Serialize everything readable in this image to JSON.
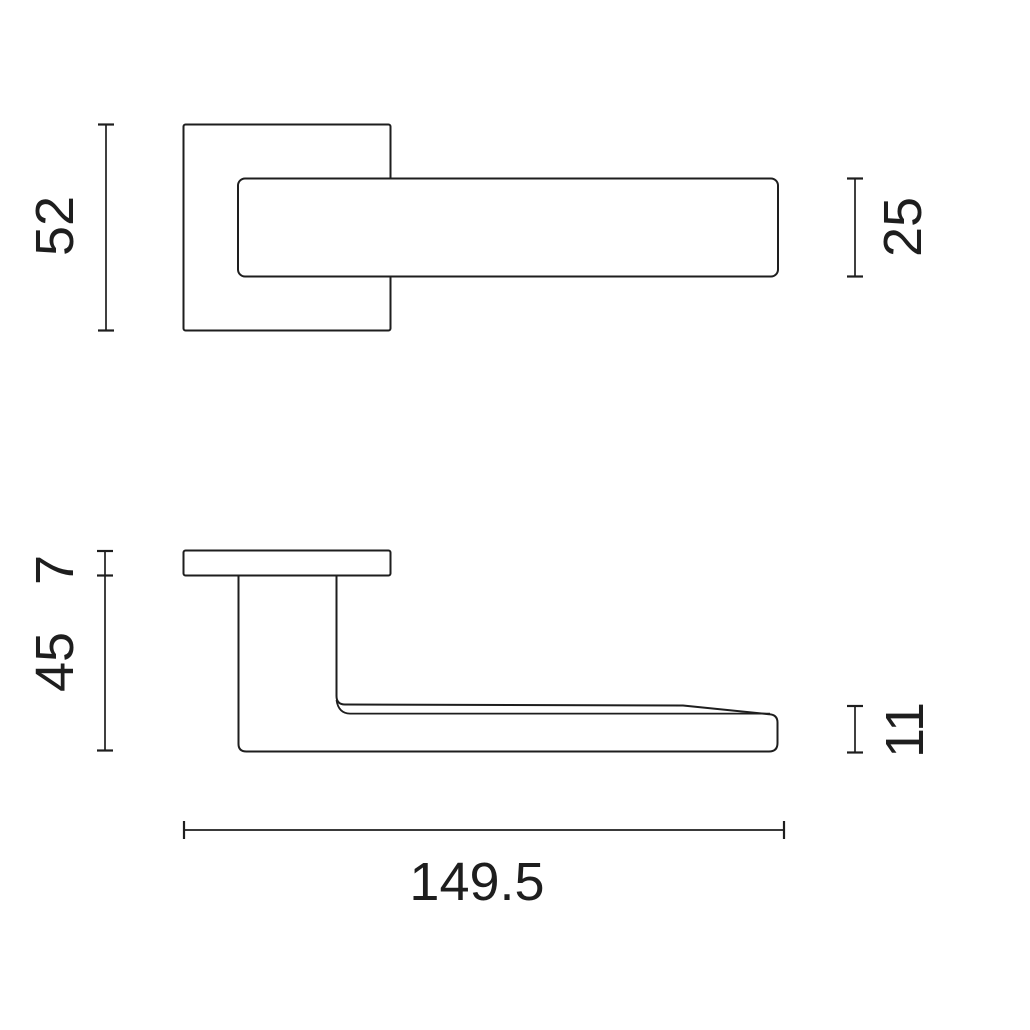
{
  "canvas": {
    "background": "#ffffff",
    "line_color": "#1e1e1e",
    "text_color": "#1e1e1e"
  },
  "dimensions": {
    "rosette_size": "52",
    "lever_bar_width": "25",
    "rosette_thickness": "7",
    "handle_projection": "45",
    "lever_thickness": "11",
    "overall_length": "149.5"
  }
}
